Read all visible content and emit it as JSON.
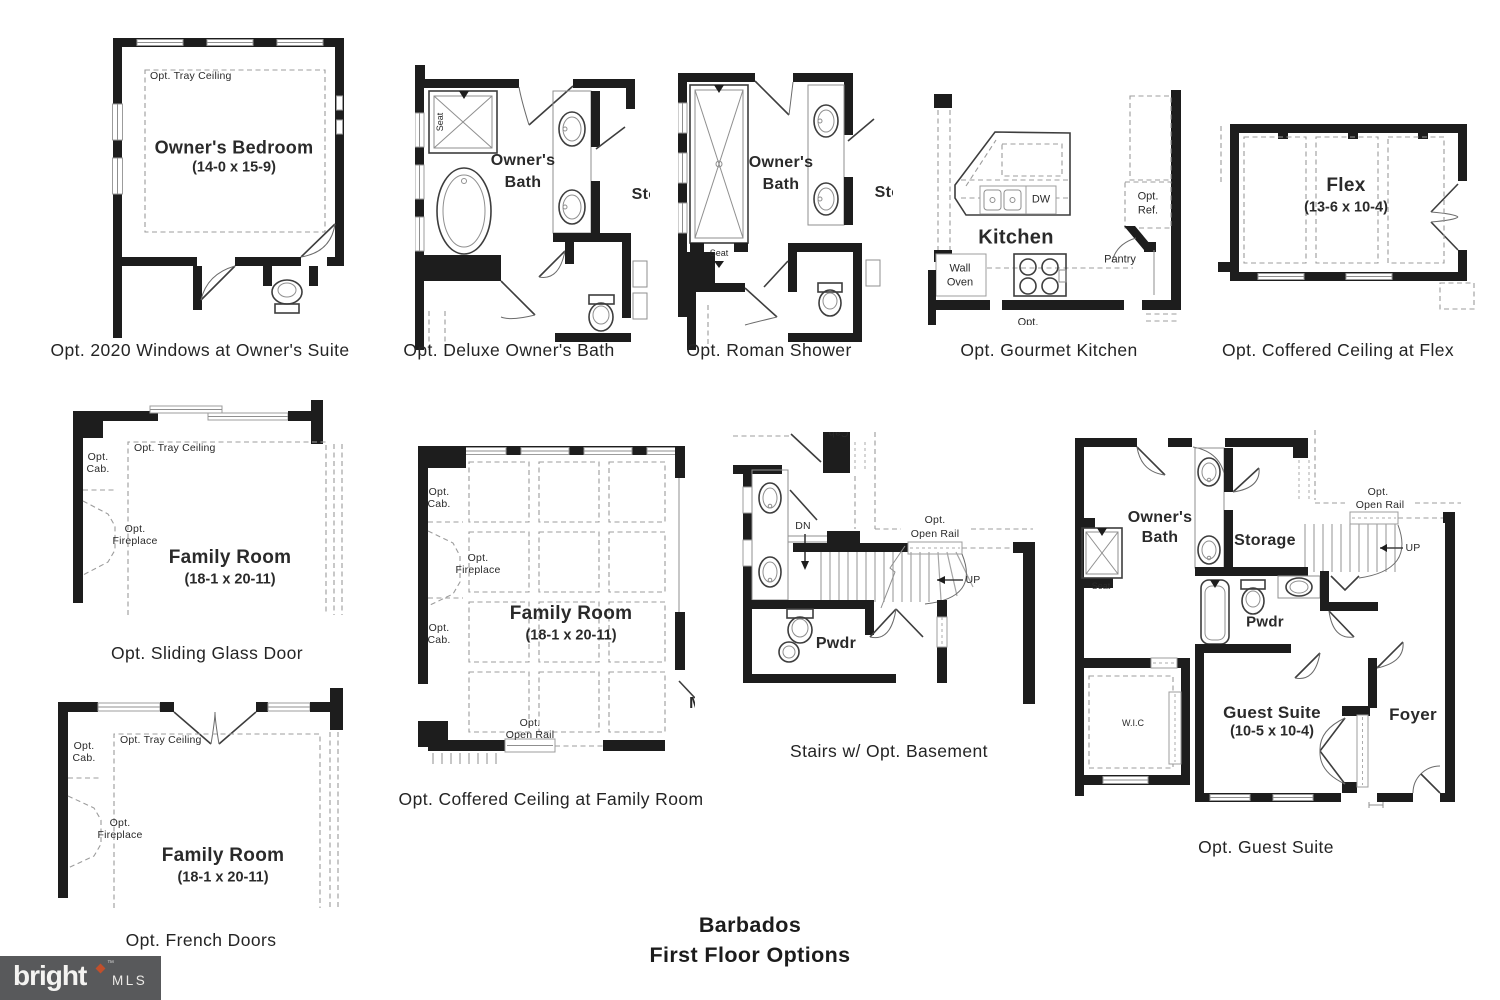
{
  "sheet": {
    "title_line1": "Barbados",
    "title_line2": "First Floor Options"
  },
  "logo": {
    "brand": "bright",
    "trademark": "™",
    "mls": "MLS",
    "bar_color": "#58595b",
    "diamond_color": "#c14f2b",
    "ink_color": "#1d1d1d"
  },
  "plans": {
    "p1": {
      "caption": "Opt. 2020 Windows at Owner's Suite",
      "tray": "Opt. Tray Ceiling",
      "room": "Owner's Bedroom",
      "dims": "(14-0 x 15-9)"
    },
    "p2": {
      "caption": "Opt. Deluxe Owner's Bath",
      "room_line1": "Owner's",
      "room_line2": "Bath",
      "seat": "Seat",
      "storage_clipped": "Sto"
    },
    "p3": {
      "caption": "Opt. Roman Shower",
      "room_line1": "Owner's",
      "room_line2": "Bath",
      "seat": "Seat",
      "storage_clipped": "Sto"
    },
    "p4": {
      "caption": "Opt. Gourmet Kitchen",
      "room": "Kitchen",
      "dw": "DW",
      "ref_line1": "Opt.",
      "ref_line2": "Ref.",
      "pantry": "Pantry",
      "oven_line1": "Wall",
      "oven_line2": "Oven",
      "opt_clipped": "Opt."
    },
    "p5": {
      "caption": "Opt. Coffered Ceiling at Flex",
      "room": "Flex",
      "dims": "(13-6 x 10-4)"
    },
    "p6": {
      "caption": "Opt. Sliding Glass Door",
      "tray": "Opt. Tray Ceiling",
      "cab": "Opt. Cab.",
      "fireplace": "Opt. Fireplace",
      "room": "Family Room",
      "dims": "(18-1 x 20-11)"
    },
    "p7": {
      "caption": "Opt. Coffered Ceiling at Family Room",
      "cab_top": "Opt. Cab.",
      "cab_bottom": "Opt. Cab.",
      "fireplace": "Opt. Fireplace",
      "room": "Family Room",
      "dims": "(18-1 x 20-11)",
      "rail_line1": "Opt.",
      "rail_line2": "Open Rail",
      "m_clipped": "M"
    },
    "p8": {
      "caption": "Stairs w/ Opt. Basement",
      "cab_clipped": "Cab.",
      "dn": "DN",
      "up": "UP",
      "pwdr": "Pwdr",
      "rail_line1": "Opt.",
      "rail_line2": "Open Rail"
    },
    "p9": {
      "caption": "Opt. Guest Suite",
      "room_line1": "Owner's",
      "room_line2": "Bath",
      "seat": "Seat",
      "storage": "Storage",
      "pwdr": "Pwdr",
      "guest_room": "Guest Suite",
      "guest_dims": "(10-5 x 10-4)",
      "wic": "W.I.C",
      "foyer": "Foyer",
      "up": "UP",
      "rail_line1": "Opt.",
      "rail_line2": "Open Rail"
    },
    "p10": {
      "caption": "Opt. French Doors",
      "tray": "Opt. Tray Ceiling",
      "cab": "Opt. Cab.",
      "fireplace": "Opt. Fireplace",
      "room": "Family Room",
      "dims": "(18-1 x 20-11)"
    }
  }
}
